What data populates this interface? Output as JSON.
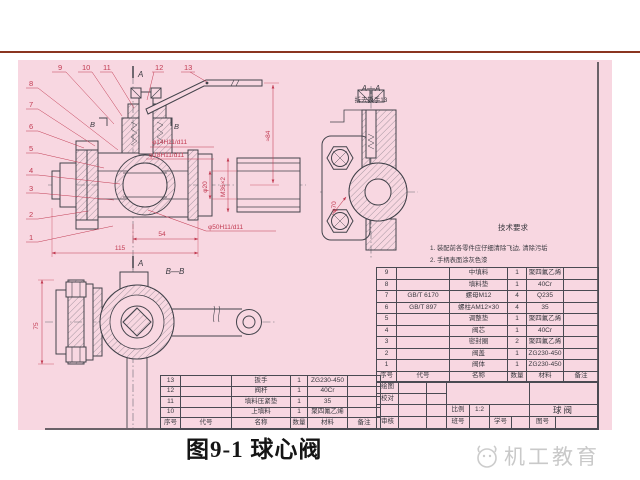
{
  "page": {
    "caption": "图9-1  球心阀",
    "watermark_text": "机工教育"
  },
  "drawing": {
    "view_labels": {
      "section_aa_title": "A—A",
      "section_aa_note": "拆去扳手13",
      "section_bb_title": "B—B",
      "cut_a_top": "A",
      "cut_a_bottom": "A",
      "cut_b_left": "B",
      "cut_b_right": "B"
    },
    "dimensions": {
      "stem_upper": "φ14H11/d11",
      "stem_lower": "φ18H11/d11",
      "bore": "φ20",
      "thread": "M36×2",
      "ball_bore": "φ50H11/d11",
      "len_54": "54",
      "len_115": "115",
      "height_84": "≈84",
      "flange_circle": "φ70",
      "height_75": "75"
    },
    "balloons": [
      "1",
      "2",
      "3",
      "4",
      "5",
      "6",
      "7",
      "8",
      "9",
      "10",
      "11",
      "12",
      "13"
    ],
    "tech_req": {
      "title": "技术要求",
      "item1": "1. 装配前各零件应仔细清除飞边, 清除污垢",
      "item2": "2. 手柄表面涂灰色漆"
    }
  },
  "bom_upper": {
    "headers": {
      "no": "序号",
      "code": "代号",
      "name": "名称",
      "qty": "数量",
      "material": "材料",
      "note": "备注"
    },
    "rows": [
      {
        "no": "9",
        "code": "",
        "name": "中填料",
        "qty": "1",
        "material": "聚四氟乙烯",
        "note": ""
      },
      {
        "no": "8",
        "code": "",
        "name": "填料垫",
        "qty": "1",
        "material": "40Cr",
        "note": ""
      },
      {
        "no": "7",
        "code": "GB/T 6170",
        "name": "螺母M12",
        "qty": "4",
        "material": "Q235",
        "note": ""
      },
      {
        "no": "6",
        "code": "GB/T 897",
        "name": "螺柱AM12×30",
        "qty": "4",
        "material": "35",
        "note": ""
      },
      {
        "no": "5",
        "code": "",
        "name": "调整垫",
        "qty": "1",
        "material": "聚四氟乙烯",
        "note": ""
      },
      {
        "no": "4",
        "code": "",
        "name": "阀芯",
        "qty": "1",
        "material": "40Cr",
        "note": ""
      },
      {
        "no": "3",
        "code": "",
        "name": "密封圈",
        "qty": "2",
        "material": "聚四氟乙烯",
        "note": ""
      },
      {
        "no": "2",
        "code": "",
        "name": "阀盖",
        "qty": "1",
        "material": "ZG230-450",
        "note": ""
      },
      {
        "no": "1",
        "code": "",
        "name": "阀体",
        "qty": "1",
        "material": "ZG230-450",
        "note": ""
      }
    ]
  },
  "bom_lower": {
    "headers": {
      "no": "序号",
      "code": "代号",
      "name": "名称",
      "qty": "数量",
      "material": "材料",
      "note": "备注"
    },
    "rows": [
      {
        "no": "13",
        "code": "",
        "name": "扳手",
        "qty": "1",
        "material": "ZG230-450",
        "note": ""
      },
      {
        "no": "12",
        "code": "",
        "name": "阀杆",
        "qty": "1",
        "material": "40Cr",
        "note": ""
      },
      {
        "no": "11",
        "code": "",
        "name": "填料压紧垫",
        "qty": "1",
        "material": "35",
        "note": ""
      },
      {
        "no": "10",
        "code": "",
        "name": "上填料",
        "qty": "1",
        "material": "聚四氟乙烯",
        "note": ""
      }
    ]
  },
  "title_block": {
    "drafter": "绘图",
    "checker": "校对",
    "reviewer": "审核",
    "scale_label": "比例",
    "scale_value": "1:2",
    "class_label": "班号",
    "student_label": "学号",
    "drawing_title": "球阀",
    "sheet_label": "图号"
  },
  "colors": {
    "sheet_pink": "#f8d7e1",
    "line_dark": "#43434b",
    "dim_red": "#c23b52",
    "rule_red": "#8a3520",
    "watermark_gray": "#c9c9c9"
  }
}
